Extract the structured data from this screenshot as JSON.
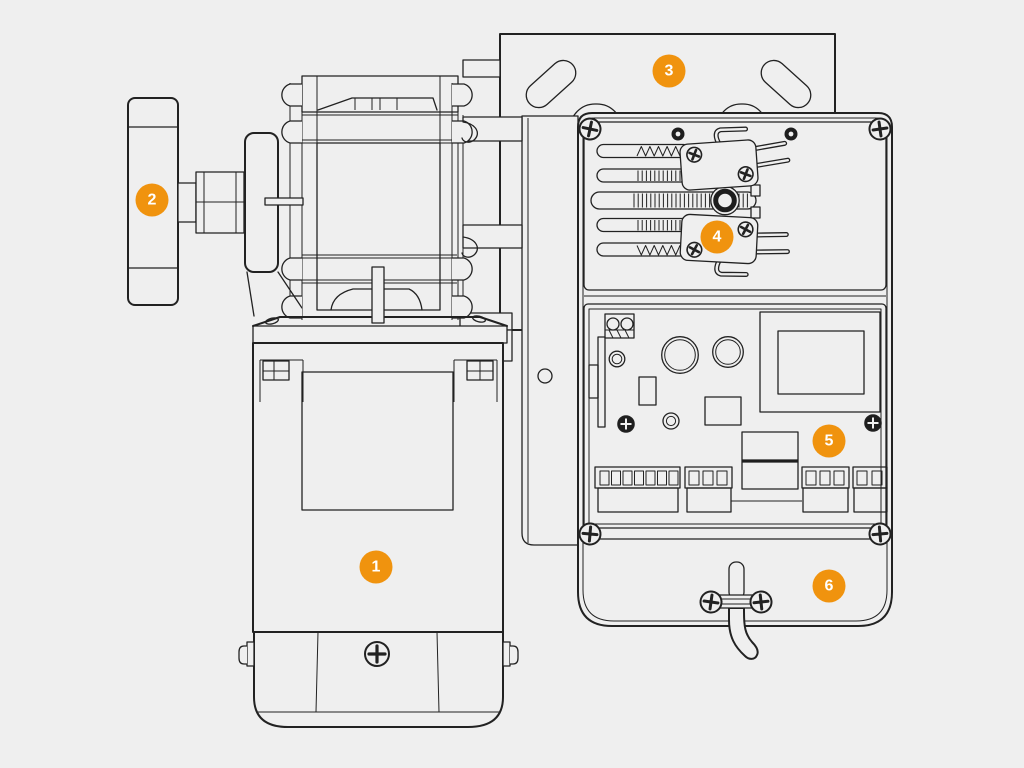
{
  "diagram": {
    "background": "#efefef",
    "line_color": "#222222",
    "badge_color": "#f0930e",
    "badge_text_color": "#ffffff",
    "callouts": [
      {
        "number": "1",
        "part": "motor-body",
        "x": 376,
        "y": 567
      },
      {
        "number": "2",
        "part": "drive-pulley",
        "x": 152,
        "y": 200
      },
      {
        "number": "3",
        "part": "mounting-plate",
        "x": 669,
        "y": 71
      },
      {
        "number": "4",
        "part": "limit-switches",
        "x": 717,
        "y": 237
      },
      {
        "number": "5",
        "part": "control-board",
        "x": 829,
        "y": 441
      },
      {
        "number": "6",
        "part": "power-cable-clamp",
        "x": 829,
        "y": 586
      }
    ]
  }
}
